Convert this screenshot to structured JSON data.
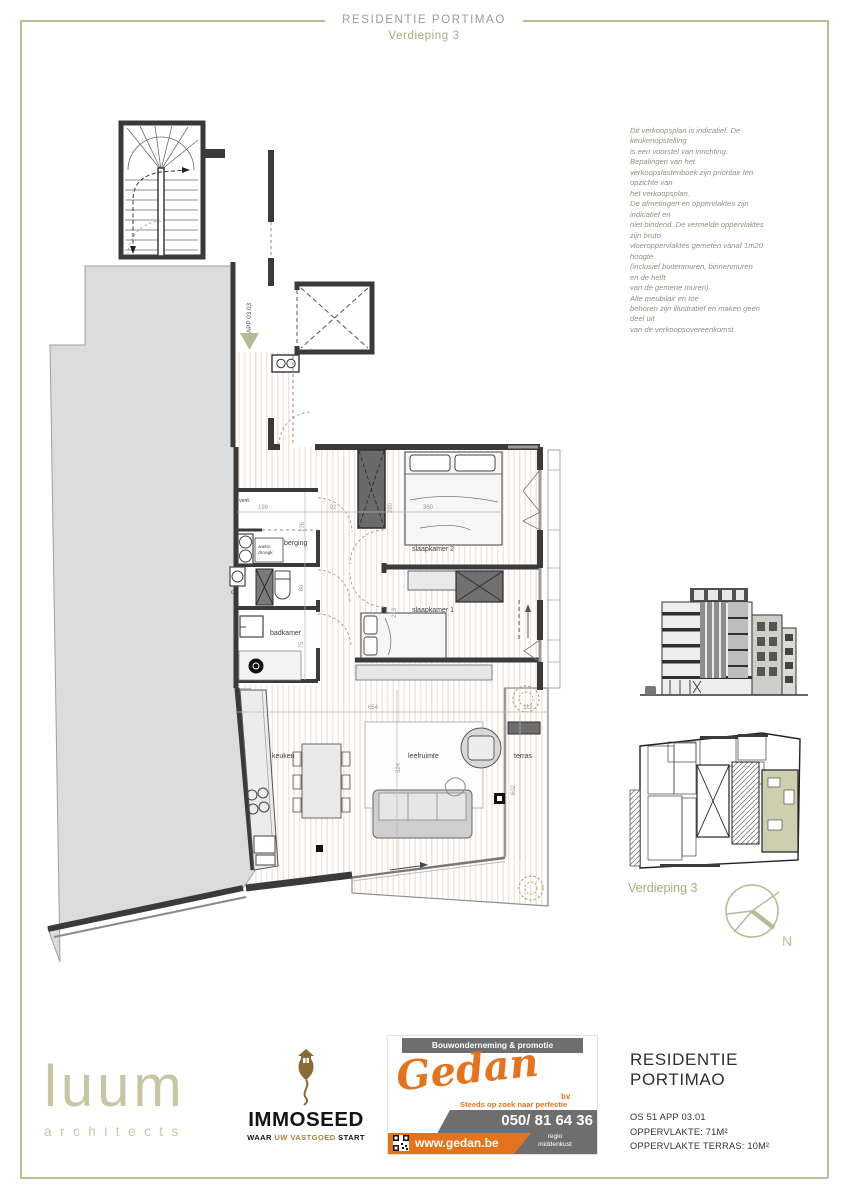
{
  "header": {
    "title": "RESIDENTIE PORTIMAO",
    "subtitle": "Verdieping 3"
  },
  "disclaimer": "Dit verkoopsplan is indicatief. De\nkeukenopstelling\nis een voorstel van inrichting.\nBepalingen van het\nverkoopslastenboek zijn prioritair ten\nopzichte van\nhet verkoopsplan.\nDe afmetingen en oppervlaktes zijn\nindicatief en\nniet bindend. De vermelde oppervlaktes\nzijn bruto\nvloeroppervlaktes gemeten vanaf 1m20\nhoogte\n(inclusief buitenmuren, binnenmuren\nen de helft\nvan de gemene muren).\nAlle meubilair en toe\nbehoren zijn illustratief en maken geen\ndeel uit\nvan de verkoopsovereenkomst.",
  "plan": {
    "app_label": "APP 03.03",
    "rooms": {
      "vent": "vent.",
      "berging": "berging",
      "wasm1": "wasm",
      "wasm2": "droogk",
      "cv": "CV",
      "badkamer": "badkamer",
      "slaapkamer2": "slaapkamer 2",
      "slaapkamer1": "slaapkamer 1",
      "keuken": "keuken",
      "leefruimte": "leefruimte",
      "terras": "terras"
    },
    "dims": {
      "d199": "199",
      "d92": "92",
      "d280": "280",
      "d360": "360",
      "d176": "176",
      "d80": "80",
      "d75": "75",
      "d213": "213",
      "d654": "654",
      "d524": "524",
      "d112": "112",
      "d602": "602"
    }
  },
  "side": {
    "floor_label": "Verdieping 3",
    "compass_n": "N"
  },
  "footer": {
    "luum": {
      "name": "luum",
      "sub": "architects"
    },
    "immoseed": {
      "name": "IMMOSEED",
      "tag1": "WAAR ",
      "tag2": "UW VASTGOED",
      "tag3": " START"
    },
    "gedan": {
      "top": "Bouwonderneming & promotie",
      "name": "Gedan",
      "suffix": "bv",
      "tagline": "Steeds op zoek naar perfectie",
      "phone": "050/ 81 64 36",
      "site": "www.gedan.be",
      "region": "regio\nmiddenkust"
    },
    "project": {
      "line1": "RESIDENTIE",
      "line2": "PORTIMAO",
      "ref": "OS 51 APP 03.01",
      "area": "OPPERVLAKTE: 71M²",
      "terrace": "OPPERVLAKTE TERRAS: 10M²"
    }
  },
  "colors": {
    "olive": "#b9ba93",
    "olive_text": "#a9ab7c",
    "orange": "#e5731d",
    "wall": "#3a3a3a",
    "stripe": "#f3e1d3",
    "gold": "#ab8034",
    "brown": "#8a6a35"
  }
}
